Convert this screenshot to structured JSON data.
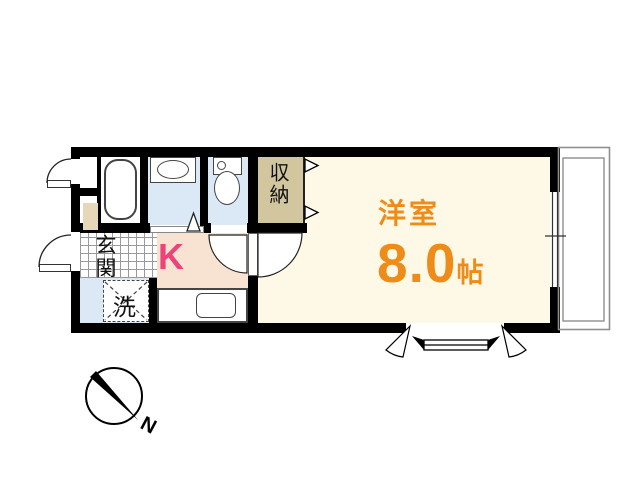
{
  "floorplan": {
    "rooms": {
      "western_room": {
        "label": "洋室",
        "size_value": "8.0",
        "size_unit": "帖"
      },
      "kitchen": {
        "label": "K"
      },
      "entrance": {
        "label": "玄関"
      },
      "storage": {
        "label": "収納"
      },
      "washer": {
        "label": "洗"
      }
    },
    "compass": {
      "north_label": "N"
    },
    "colors": {
      "western_room_bg": "#fdf9e6",
      "kitchen_bg": "#f8e3d2",
      "wet_area_bg": "#dbe9f6",
      "storage_bg": "#d2c69e",
      "shoe_box_bg": "#e5d7b8",
      "room_text_orange": "#ee8c1a",
      "kitchen_text_pink": "#ee4379",
      "wall": "#000000",
      "balcony_line": "#8f8f8f"
    }
  }
}
